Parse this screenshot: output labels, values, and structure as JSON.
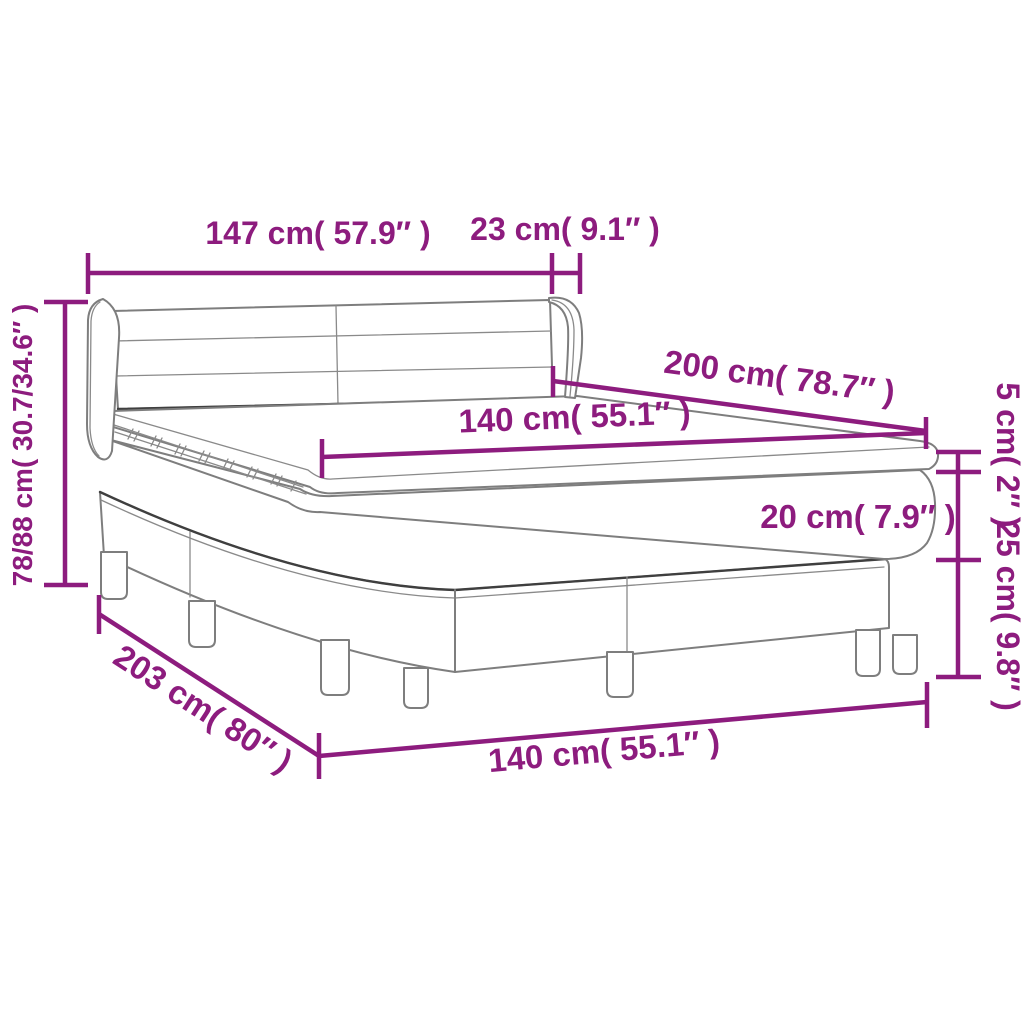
{
  "diagram": {
    "type": "product-dimension-diagram",
    "subject": "box spring bed with winged headboard, mattress topper, mattress and slatted base on legs",
    "background_color": "#ffffff",
    "dimension_color": "#8d1c7e",
    "outline_color": "#7e7e7e",
    "outline_dark_color": "#3f3f3f",
    "labels": {
      "headboard_width": "147 cm( 57.9″ )",
      "headboard_wing_depth": "23 cm( 9.1″ )",
      "headboard_height": "78/88 cm( 30.7/34.6″ )",
      "bed_length": "200 cm( 78.7″ )",
      "mattress_width": "140 cm( 55.1″ )",
      "topper_thickness": "5 cm( 2″ )",
      "mattress_thickness": "20 cm( 7.9″ )",
      "base_height": "25 cm( 9.8″ )",
      "base_length": "203 cm( 80″ )",
      "base_width": "140 cm( 55.1″ )"
    }
  }
}
